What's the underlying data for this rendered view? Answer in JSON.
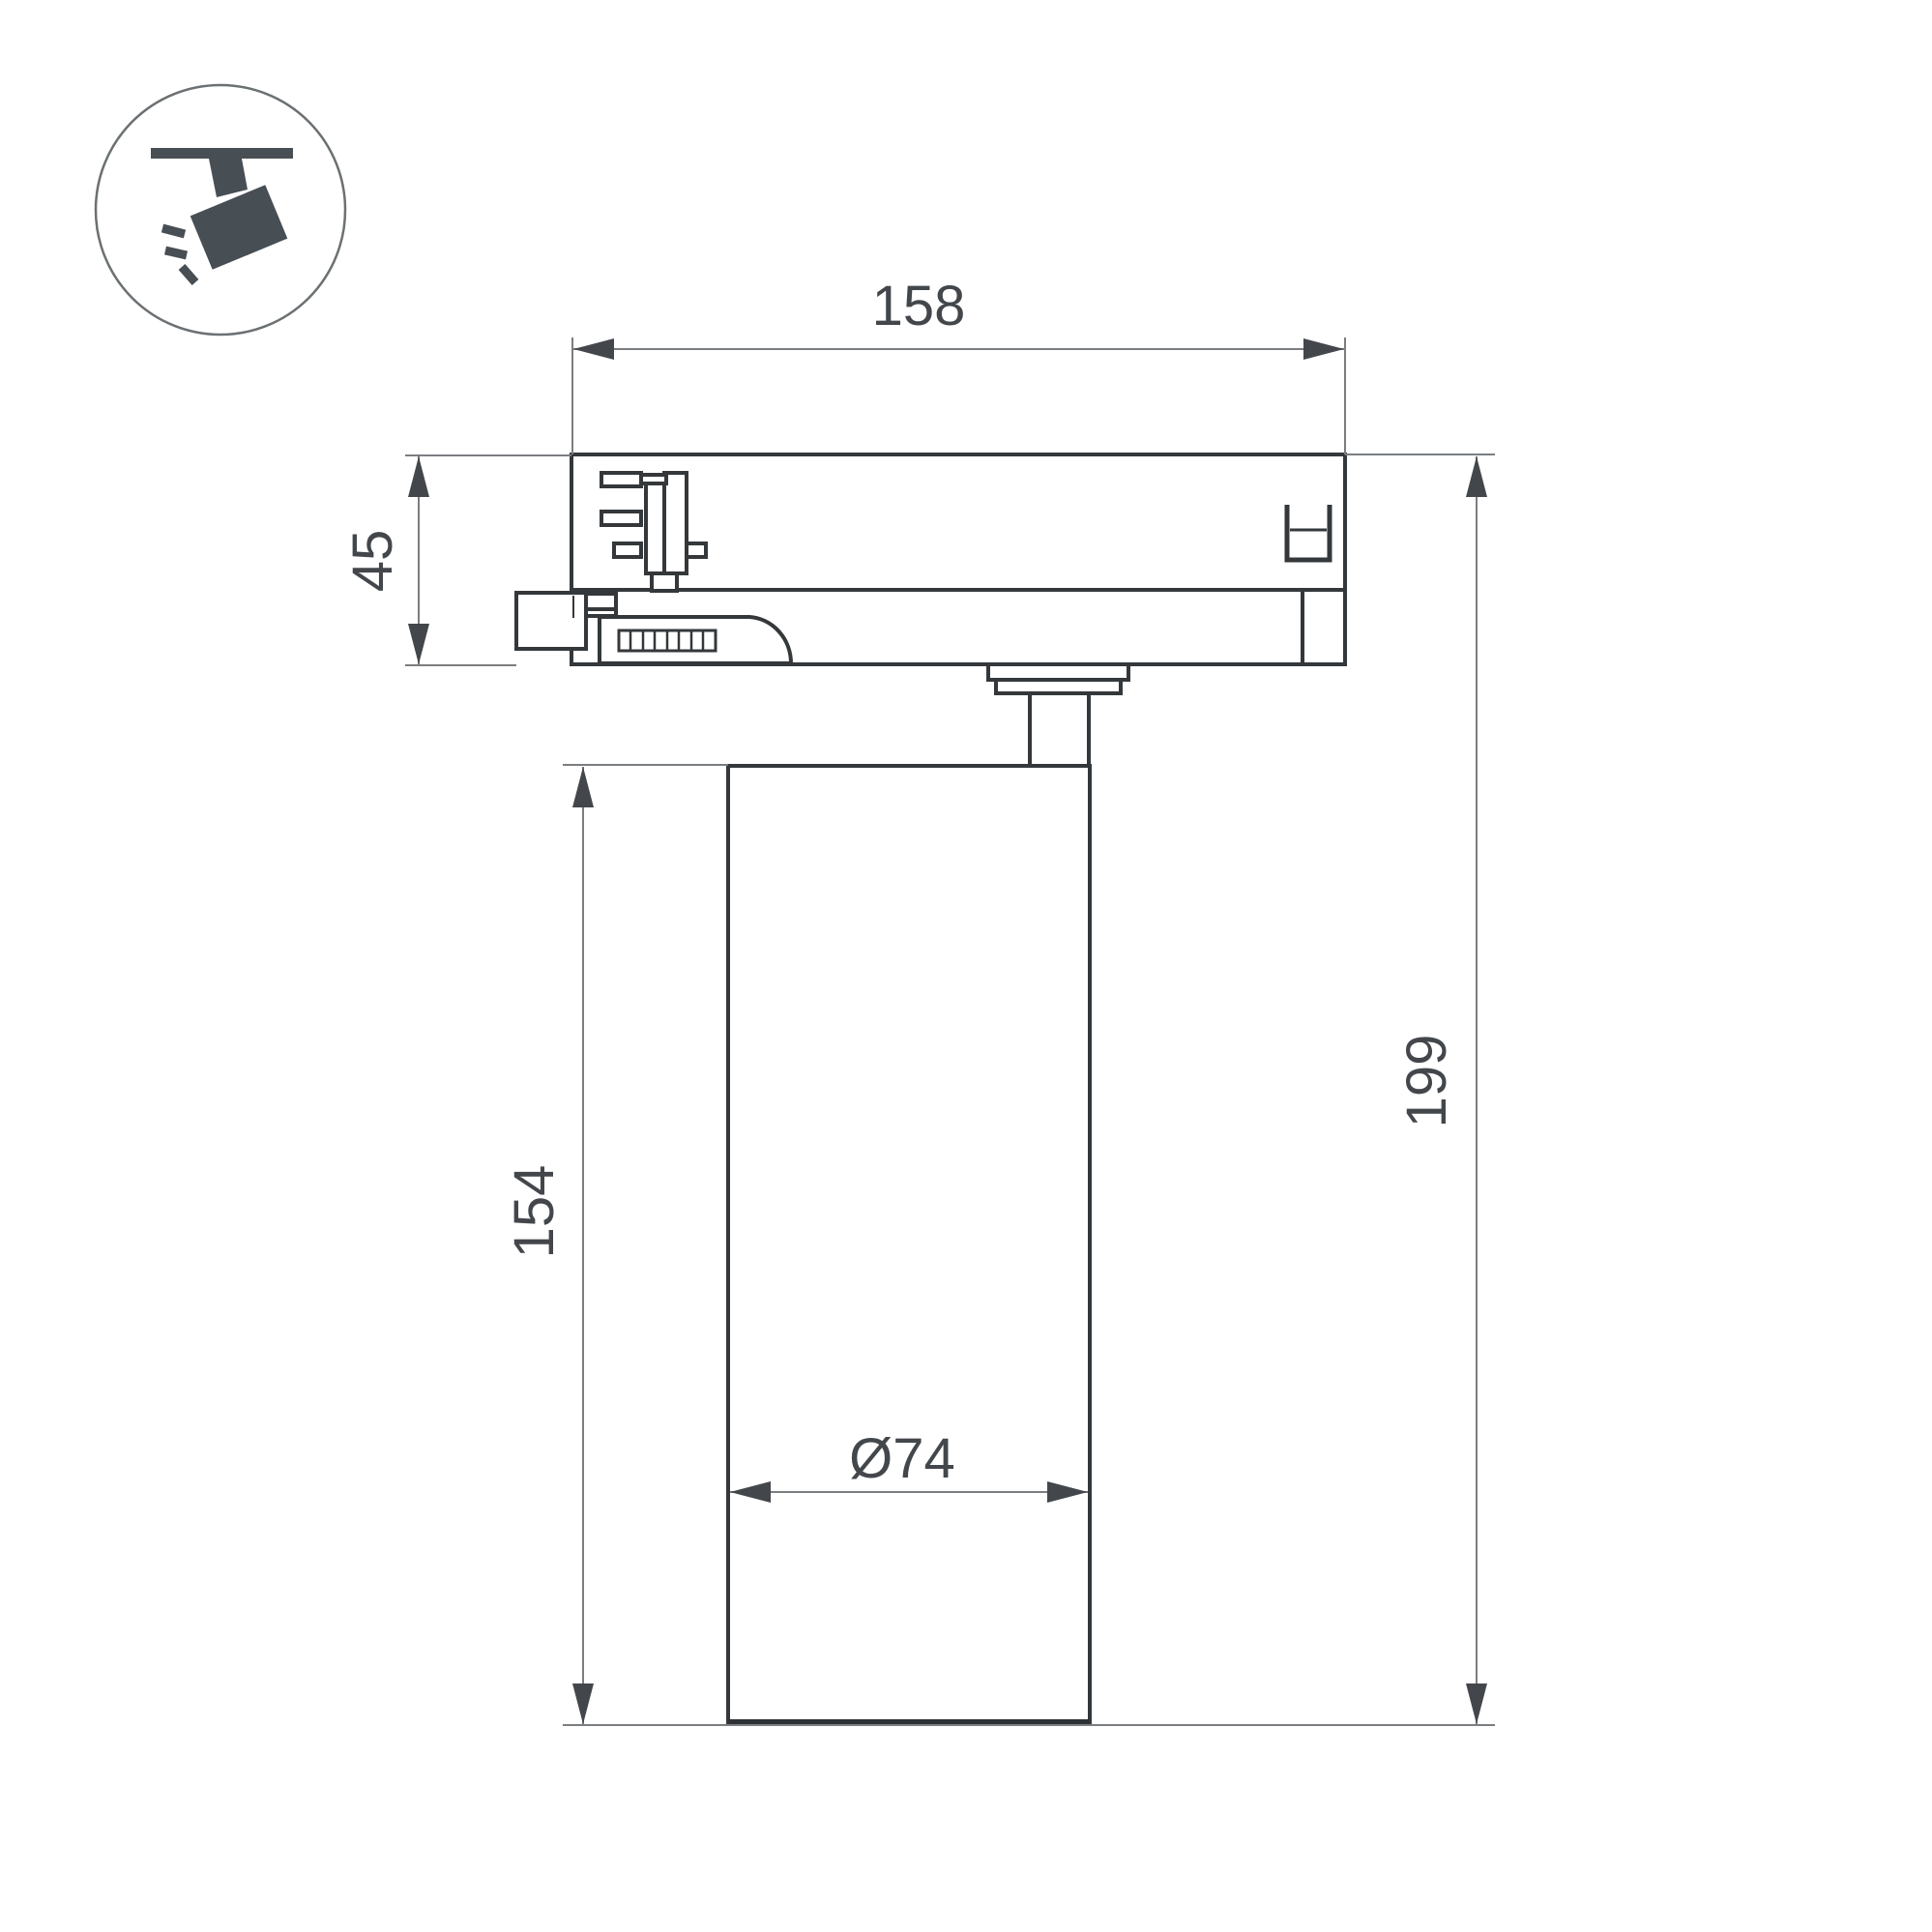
{
  "icon": {
    "name": "track-spotlight-icon"
  },
  "dimensions": {
    "overall_width": "158",
    "adapter_height": "45",
    "body_height": "154",
    "overall_height": "199",
    "body_diameter": "Ø74"
  },
  "colors": {
    "background": "#ffffff",
    "outline": "#34383b",
    "dimension_line": "#7b7e81",
    "dimension_text": "#43474b",
    "icon_glyph": "#474e54",
    "icon_ring": "#6b7073"
  }
}
